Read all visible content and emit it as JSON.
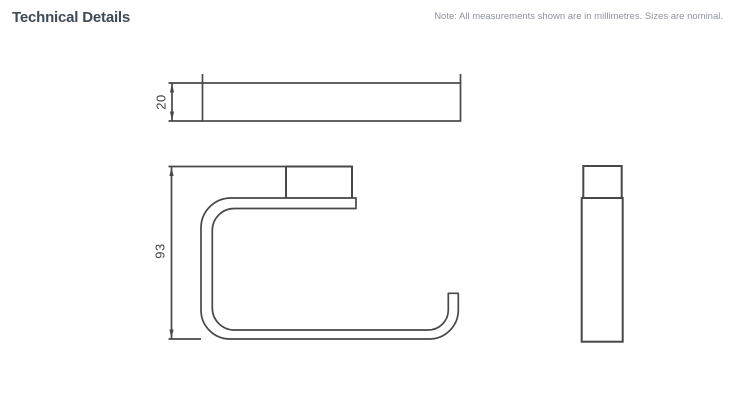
{
  "header": {
    "title": "Technical Details",
    "note": "Note: All measurements shown are in millimetres. Sizes are nominal."
  },
  "drawing": {
    "units": "millimetres",
    "views": [
      {
        "id": "top-view"
      },
      {
        "id": "front-view"
      },
      {
        "id": "side-view"
      }
    ],
    "dimensions": {
      "depth": {
        "label": "20",
        "view": "top-view",
        "orientation": "vertical"
      },
      "height": {
        "label": "93",
        "view": "front-view",
        "orientation": "vertical"
      }
    }
  },
  "colors": {
    "background": "#ffffff",
    "title": "#3e4a54",
    "note": "#8f959d",
    "line": "#484848",
    "dim_text": "#404040"
  }
}
